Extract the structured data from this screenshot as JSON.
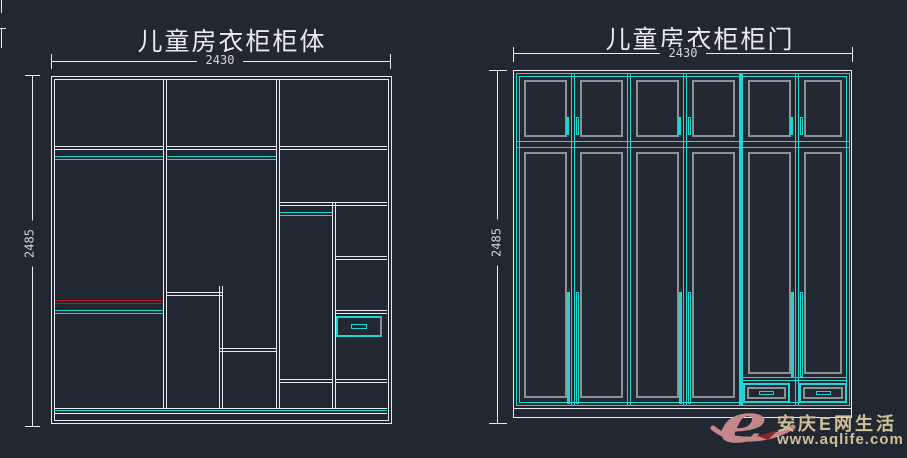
{
  "colors": {
    "background": "#222831",
    "line": "#e9ebed",
    "cyan": "#1fd6d6",
    "gray": "#8e9194",
    "red": "#bf1414",
    "dim": "#d4d6d8",
    "wmlogo": "#c4888c",
    "wmtext": "#cfc098",
    "wmred": "#8d2626"
  },
  "left_drawing": {
    "title": "儿童房衣柜柜体",
    "width_dim": "2430",
    "height_dim": "2485"
  },
  "right_drawing": {
    "title": "儿童房衣柜柜门",
    "width_dim": "2430",
    "height_dim": "2485"
  },
  "watermark": {
    "logo_letter": "e",
    "site_name": "安庆E网生活",
    "site_url": "www.aqlife.com"
  }
}
